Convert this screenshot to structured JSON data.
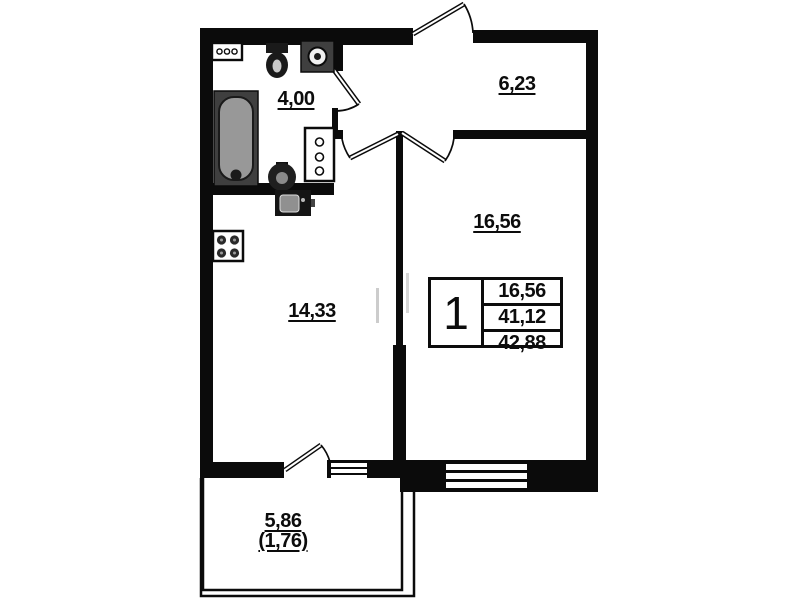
{
  "plan_title": "one-room-apartment-floor-plan",
  "rooms": {
    "bathroom": {
      "label": "4,00"
    },
    "hallway": {
      "label": "6,23"
    },
    "living_room": {
      "label": "16,56"
    },
    "kitchen": {
      "label": "14,33"
    },
    "balcony": {
      "label": "5,86",
      "label_secondary": "(1,76)"
    }
  },
  "info_table": {
    "rooms_count": "1",
    "living_area": "16,56",
    "apartment_area": "41,12",
    "total_area": "42,88"
  },
  "fixtures": [
    "vent-grille",
    "toilet",
    "washing-machine",
    "bathtub",
    "wash-basin",
    "cabinet",
    "kitchen-sink",
    "stove"
  ],
  "doors": [
    "entrance-door",
    "bathroom-door",
    "kitchen-door",
    "living-room-door",
    "balcony-door"
  ],
  "windows": [
    "living-room-window",
    "balcony-window"
  ],
  "colors": {
    "walls": "#0b0b0b",
    "bathtub_fill": "#989898",
    "fixture_hatch": "#3f3f3f",
    "background": "#ffffff"
  }
}
